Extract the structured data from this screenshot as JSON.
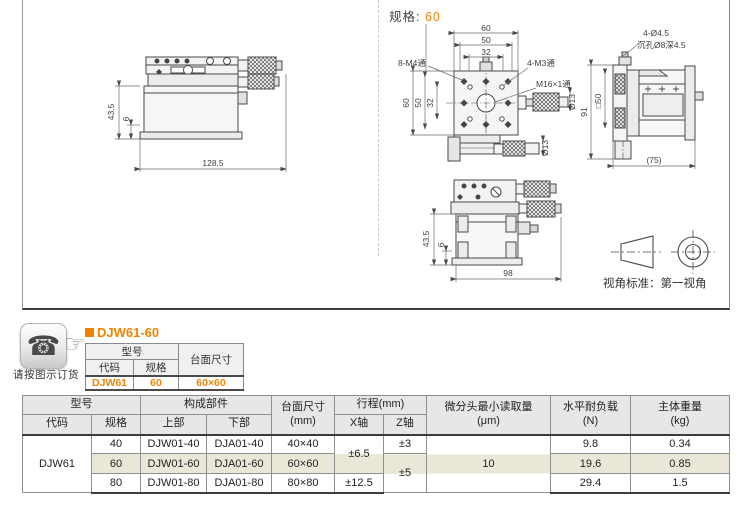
{
  "colors": {
    "accent": "#f08300",
    "row_highlight": "#ebe7d8",
    "table_header_bg": "#e7e7e7"
  },
  "icons": {
    "phone": "☎",
    "hand": "☞"
  },
  "spec_header": {
    "label": "规格:",
    "value": "60"
  },
  "drawings": {
    "side_view": {
      "dim_height": "43.5",
      "dim_base": "6",
      "dim_width": "128.5"
    },
    "plan_view": {
      "dim_top_60": "60",
      "dim_top_50": "50",
      "dim_top_32": "32",
      "dim_left_60": "60",
      "dim_left_50": "50",
      "dim_left_32": "32",
      "label_8m4": "8-M4通",
      "label_4m3": "4-M3通",
      "label_m16": "M16×1通",
      "label_dia13_side": "Ø13",
      "label_dia13_bottom": "Ø13"
    },
    "right_view": {
      "label_holes": "4-Ø4.5",
      "label_counterbore": "沉孔Ø8深4.5",
      "dim_square": "□50",
      "dim_height": "91",
      "dim_width": "(75)"
    },
    "front_view": {
      "dim_height": "43.5",
      "dim_base": "6",
      "dim_width": "98"
    },
    "projection_note": "视角标准：第一视角"
  },
  "order_note": "请按图示订货",
  "product": {
    "title": "DJW61-60",
    "table": {
      "model_header": "型号",
      "code_header": "代码",
      "spec_header": "规格",
      "size_header": "台面尺寸",
      "code": "DJW61",
      "spec": "60",
      "size": "60×60"
    }
  },
  "spec_table": {
    "headers": {
      "model": "型号",
      "code": "代码",
      "spec": "规格",
      "components": "构成部件",
      "upper": "上部",
      "lower": "下部",
      "size_line1": "台面尺寸",
      "size_line2": "(mm)",
      "travel": "行程(mm)",
      "x_axis": "X轴",
      "z_axis": "Z轴",
      "resolution_line1": "微分头最小读取量",
      "resolution_line2": "(μm)",
      "load_line1": "水平耐负载",
      "load_line2": "(N)",
      "weight_line1": "主体重量",
      "weight_line2": "(kg)"
    },
    "code": "DJW61",
    "rows": [
      {
        "spec": "40",
        "upper": "DJW01-40",
        "lower": "DJA01-40",
        "size": "40×40",
        "travel_x": "±6.5",
        "travel_z": "±3",
        "resolution": "10",
        "load": "9.8",
        "weight": "0.34"
      },
      {
        "spec": "60",
        "upper": "DJW01-60",
        "lower": "DJA01-60",
        "size": "60×60",
        "travel_z": "±5",
        "load": "19.6",
        "weight": "0.85"
      },
      {
        "spec": "80",
        "upper": "DJW01-80",
        "lower": "DJA01-80",
        "size": "80×80",
        "travel_x": "±12.5",
        "load": "29.4",
        "weight": "1.5"
      }
    ]
  }
}
